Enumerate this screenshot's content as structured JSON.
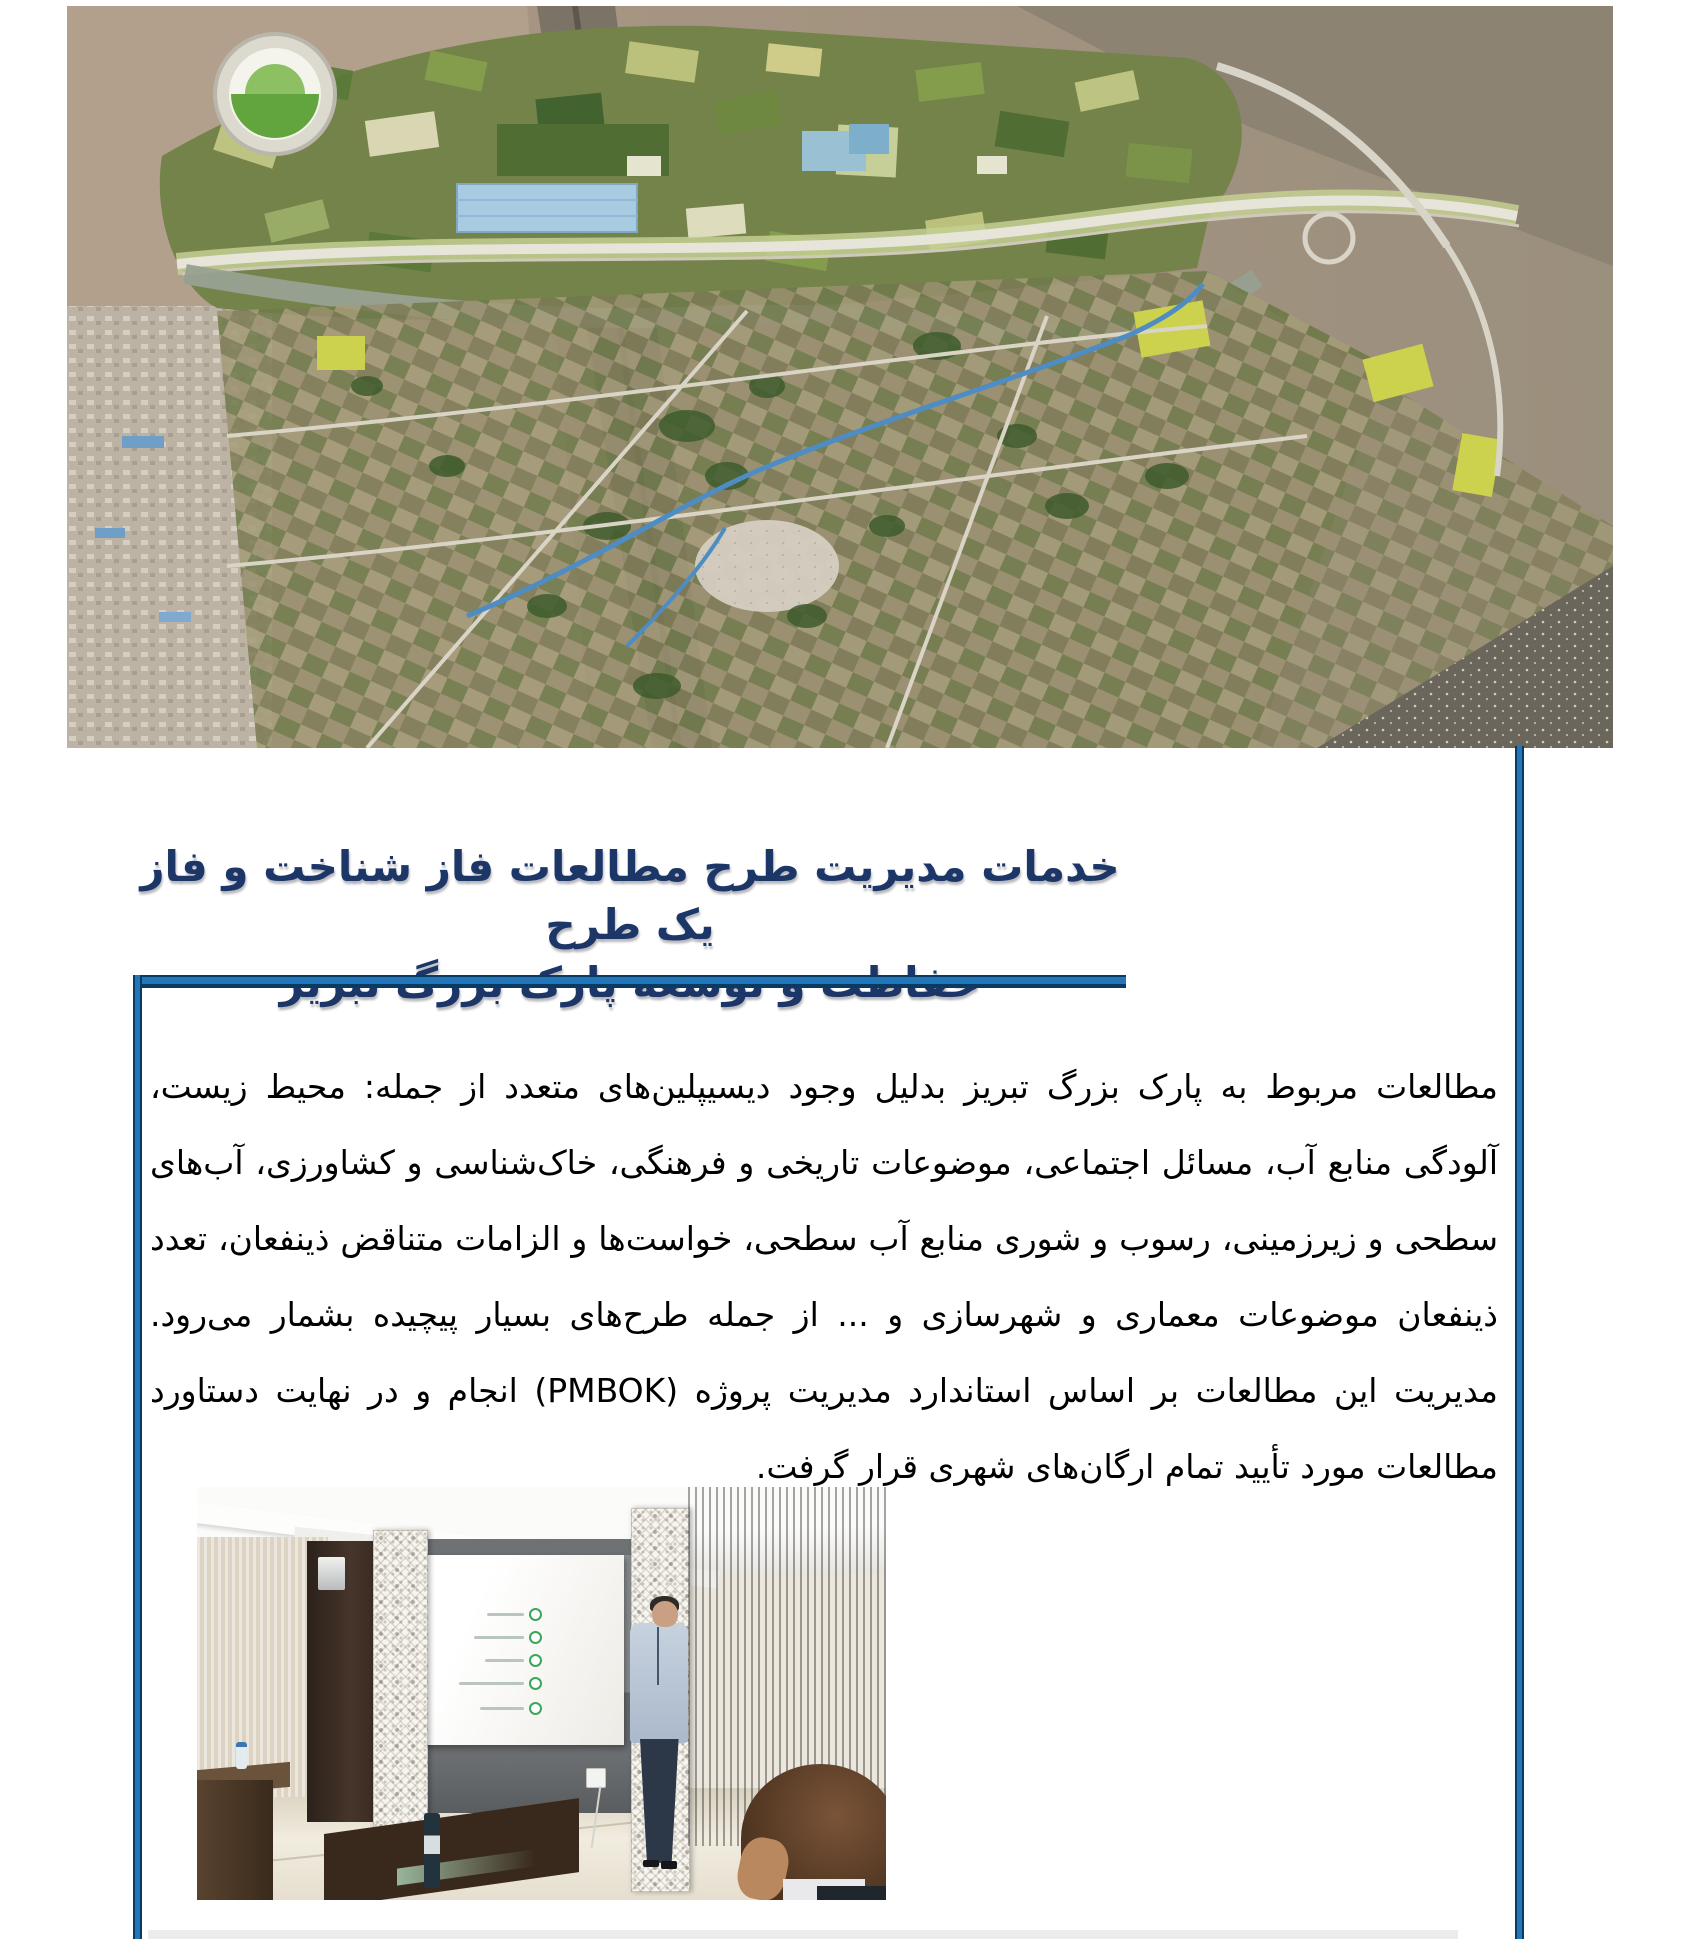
{
  "page": {
    "accent_blue": "#2277bb",
    "rule_dark_blue": "#0a3a61",
    "heading_color": "#1b3667"
  },
  "map_figure": {
    "caption": "نگاره ۳۷ - تصویر شبیه‌سازی شده پارک بزرگ تبریز",
    "caption_color": "#f5f5f0"
  },
  "heading": {
    "line1": "خدمات مدیریت طرح مطالعات فاز شناخت و فاز یک طرح",
    "line2": "حفاظت و توسعه پارک بزرگ تبریز"
  },
  "body": {
    "paragraph": "مطالعات مربوط به پارک بزرگ تبریز بدلیل وجود دیسیپلین‌های متعدد از جمله: محیط زیست، آلودگی منابع آب، مسائل اجتماعی، موضوعات تاریخی و فرهنگی، خاک‌شناسی و کشاورزی، آب‌های سطحی و زیرزمینی، رسوب و شوری منابع آب سطحی، خواست‌ها و الزامات متناقض ذینفعان، تعدد ذینفعان موضوعات معماری و شهرسازی و ... از جمله طرح‌های بسیار پیچیده بشمار می‌رود. مدیریت این مطالعات بر اساس استاندارد مدیریت پروژه (PMBOK) انجام و در نهایت دستاورد مطالعات مورد تأیید تمام ارگان‌های شهری قرار گرفت."
  },
  "photo": {
    "slide_bullet_color": "#3aa65a"
  }
}
